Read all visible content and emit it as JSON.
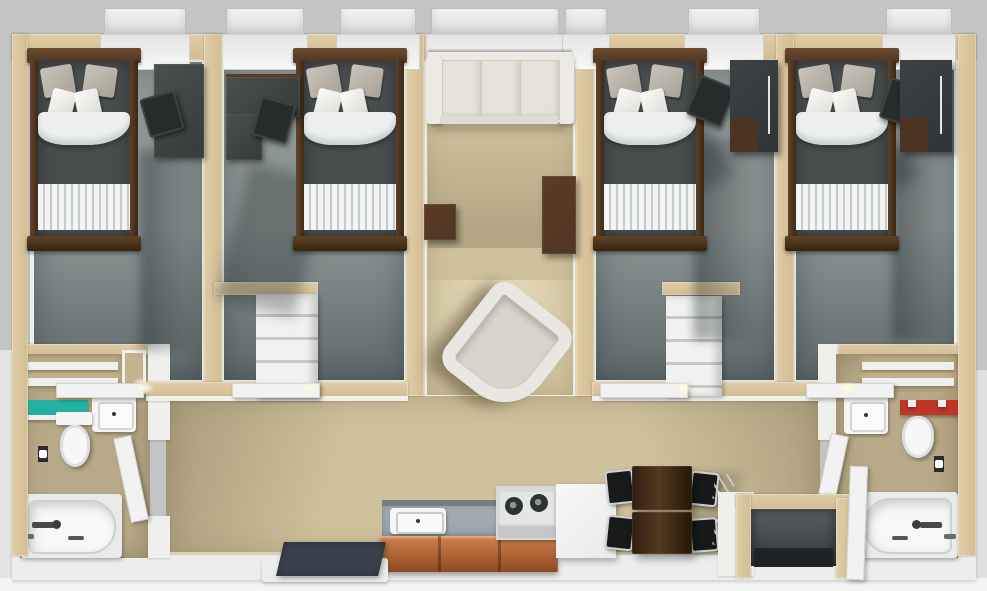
{
  "scene": {
    "description": "3D rendered top-down dollhouse floor plan of a four-bedroom apartment unit with central living room, kitchen, dining nook, two bathrooms and entry vestibule",
    "view": "top-down 3d architectural render, no visible text"
  },
  "rooms": [
    {
      "name": "bedroom-1",
      "furniture": [
        "twin bed with dark duvet and striped foot",
        "dark desk",
        "black desk chair",
        "door",
        "window"
      ]
    },
    {
      "name": "bedroom-2",
      "furniture": [
        "twin bed with dark duvet and striped foot",
        "dark L-desk",
        "black desk chair",
        "door",
        "window"
      ]
    },
    {
      "name": "living-room",
      "furniture": [
        "cream three-seat sofa",
        "dark wood side table",
        "dark wood console table",
        "white tub chair",
        "window"
      ]
    },
    {
      "name": "bedroom-3",
      "furniture": [
        "twin bed with dark duvet and striped foot",
        "black desk chair",
        "dark wardrobe",
        "door",
        "window"
      ]
    },
    {
      "name": "bedroom-4",
      "furniture": [
        "twin bed with dark duvet and striped foot",
        "black desk chair",
        "dark wardrobe",
        "door",
        "window"
      ]
    },
    {
      "name": "bathroom-left",
      "furniture": [
        "bathtub",
        "toilet",
        "white sink",
        "teal vanity shelf",
        "two wall shelves",
        "toilet paper holder",
        "door"
      ]
    },
    {
      "name": "bathroom-right",
      "furniture": [
        "bathtub",
        "toilet",
        "white sink",
        "red vanity shelf",
        "two wall shelves",
        "toilet paper holder",
        "door"
      ]
    },
    {
      "name": "kitchen",
      "furniture": [
        "gray counter with white sink",
        "two-burner cooktop",
        "white refrigerator",
        "orange-brown wood cabinets"
      ]
    },
    {
      "name": "dining-nook",
      "furniture": [
        "two dark wood tables",
        "four black metal-frame chairs"
      ]
    },
    {
      "name": "entry",
      "furniture": [
        "dark entry mat on white platform",
        "entry vestibule with dark mat",
        "white entry door"
      ]
    },
    {
      "name": "closets",
      "furniture": [
        "two white shelved closets between bedroom pairs"
      ]
    }
  ],
  "palette": {
    "bg": "#c3c4c6",
    "wallTan": "#d2bd94",
    "wallWhite": "#eff0ec",
    "carpet": "#8d9595",
    "floorTan": "#cfc19c",
    "bathFloor": "#b8aa88",
    "bathWall": "#c3b38e",
    "wood": "#4e3726",
    "woodLight": "#6b4a2a",
    "duvet": "#484d4e",
    "pillowGray": "#a8a296",
    "blanket": "#edeff0",
    "stripe": "#c6cacb",
    "desk": "#363b3c",
    "chair": "#272b2c",
    "ward": "#2f3436",
    "sofa": "#e6e3da",
    "sofaLight": "#eceae3",
    "tubRim": "#e9e7e1",
    "tubSeat": "#d8d5cb",
    "counter": "#98a2a9",
    "counterEdge": "#757d82",
    "cab2": "#8f4a24",
    "appl": "#d8dad9",
    "fridge": "#e9eae9",
    "burner": "#2f3233",
    "dining": "#54381f",
    "metal": "#cfd2d2",
    "mat": "#3a414d",
    "matBlack": "#1f2325",
    "teal": "#23b1a1",
    "red": "#bf3628",
    "fixture": "#f4f5f4",
    "tubInner": "#f7f8f8"
  }
}
